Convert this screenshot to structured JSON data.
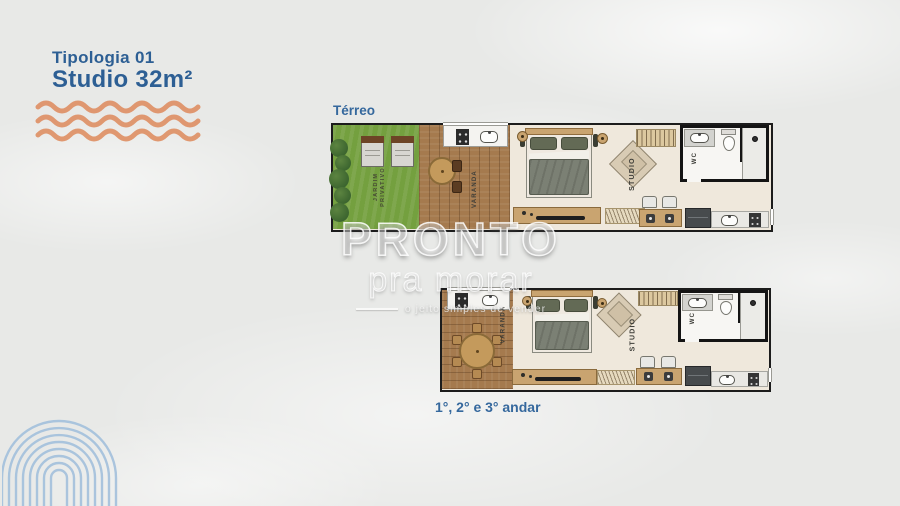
{
  "header": {
    "subtitle": "Tipologia 01",
    "title": "Studio 32m²"
  },
  "plans": {
    "terreo": {
      "label": "Térreo",
      "jardim_label": "JARDIM PRIVATIVO",
      "varanda_label": "VARANDA",
      "studio_label": "STUDIO",
      "wc_label": "WC"
    },
    "andares": {
      "label": "1°, 2° e 3° andar",
      "varanda_label": "VARANDA",
      "studio_label": "STUDIO",
      "wc_label": "WC"
    }
  },
  "watermark": {
    "brand": "PRONTO",
    "sub": "pra morar",
    "tagline": "o jeito simples de vender"
  },
  "colors": {
    "accent_blue": "#2d5f94",
    "label_blue": "#35689d",
    "wave_orange": "#df9166",
    "garden_green": "#74a03f",
    "deck_wood": "#a57a4e",
    "wall_black": "#1c1c1c",
    "floor_cream": "#efe8dc",
    "fingerprint_blue": "#a3c0dc"
  }
}
